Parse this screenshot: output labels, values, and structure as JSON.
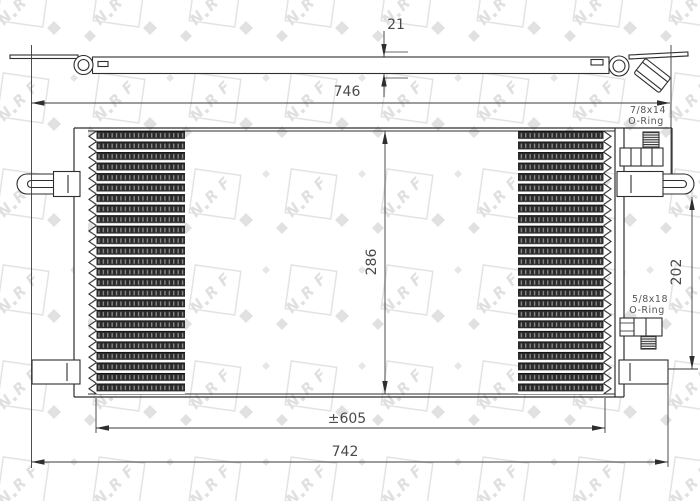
{
  "watermark": {
    "brand_letters": [
      "N",
      "R",
      "F"
    ]
  },
  "side_view": {
    "thickness_dim": "21"
  },
  "front_view": {
    "width_top_dim": "746",
    "height_dim": "286",
    "core_width_dim": "±605",
    "width_bottom_dim": "742",
    "ports_height_dim": "202",
    "top_port": {
      "thread": "7/8x14",
      "seal": "O-Ring"
    },
    "bottom_port": {
      "thread": "5/8x18",
      "seal": "O-Ring"
    }
  },
  "colors": {
    "line": "#2e2e2e",
    "dim_text": "#4a4a4a",
    "fin": "#2b2b2b",
    "watermark": "#e3e3e3",
    "background": "#ffffff"
  }
}
